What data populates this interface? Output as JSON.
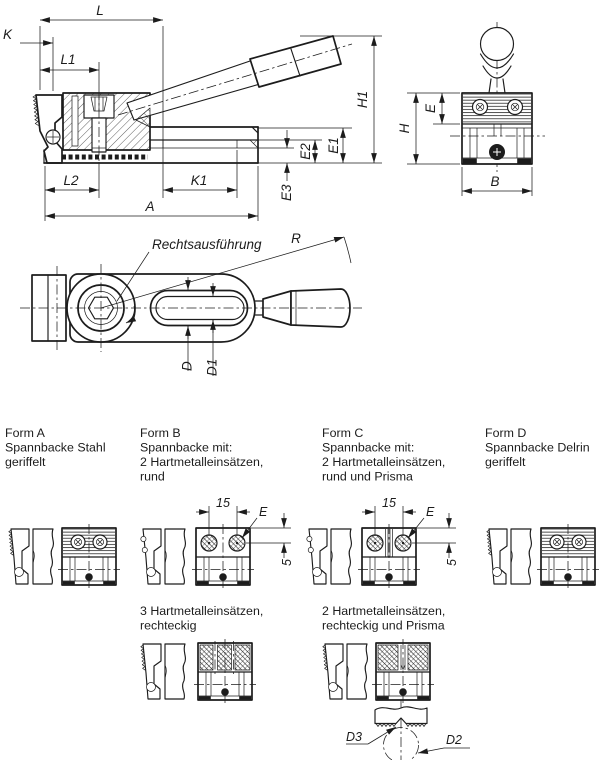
{
  "colors": {
    "ink": "#1c1c1c",
    "paper": "#ffffff"
  },
  "side_view": {
    "L": "L",
    "K": "K",
    "L1": "L1",
    "L2": "L2",
    "K1": "K1",
    "A": "A",
    "E1": "E1",
    "E2": "E2",
    "E3": "E3",
    "H1": "H1"
  },
  "front_view": {
    "H": "H",
    "E": "E",
    "B": "B"
  },
  "top_view": {
    "note": "Rechtsausführung",
    "R": "R",
    "D": "D",
    "D1": "D1"
  },
  "forms": {
    "a": {
      "title": "Form A",
      "line1": "Spannbacke Stahl",
      "line2": "geriffelt"
    },
    "b": {
      "title": "Form B",
      "line1": "Spannbacke mit:",
      "line2": "2 Hartmetalleinsätzen,",
      "line3": "rund",
      "alt1": "3 Hartmetalleinsätzen,",
      "alt2": "rechteckig",
      "dim15": "15",
      "dimE": "E",
      "dim5": "5"
    },
    "c": {
      "title": "Form C",
      "line1": "Spannbacke mit:",
      "line2": "2 Hartmetalleinsätzen,",
      "line3": "rund und Prisma",
      "alt1": "2 Hartmetalleinsätzen,",
      "alt2": "rechteckig und Prisma",
      "dim15": "15",
      "dimE": "E",
      "dim5": "5",
      "d3": "D3",
      "d2": "D2"
    },
    "d": {
      "title": "Form D",
      "line1": "Spannbacke Delrin",
      "line2": "geriffelt"
    }
  }
}
